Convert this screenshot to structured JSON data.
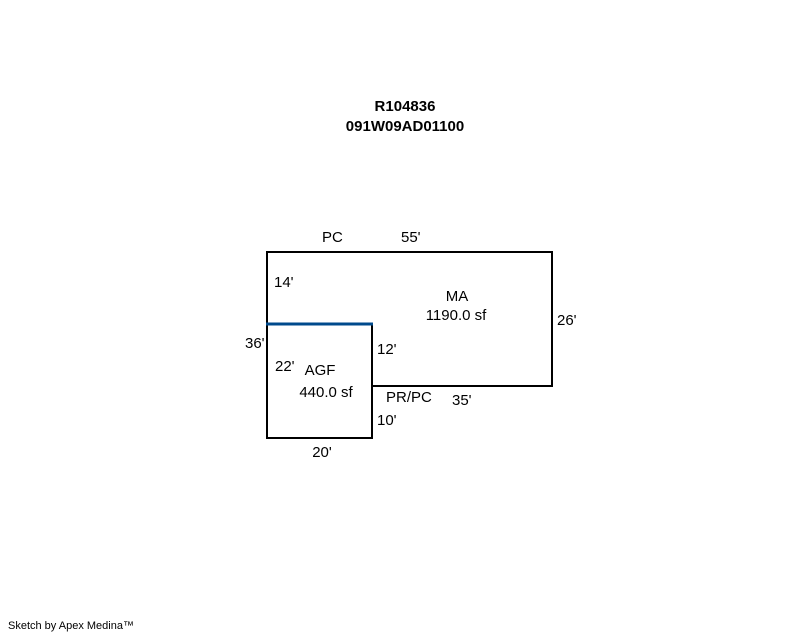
{
  "title": {
    "line1": "R104836",
    "line2": "091W09AD01100"
  },
  "sketch": {
    "areas": {
      "ma": {
        "name": "MA",
        "size": "1190.0 sf"
      },
      "agf": {
        "name": "AGF",
        "size": "440.0 sf"
      }
    },
    "dimensions": {
      "top_label": "PC",
      "top_length": "55'",
      "upper_left": "14'",
      "right": "26'",
      "left_total": "36'",
      "inner_upper": "12'",
      "agf_left": "22'",
      "bottom_right_label": "PR/PC",
      "bottom_right_length": "35'",
      "inner_lower": "10'",
      "agf_bottom": "20'"
    }
  },
  "footer": {
    "credit": "Sketch by Apex Medina™"
  },
  "colors": {
    "outline": "#000000",
    "agf_highlight": "#004a8c",
    "background": "#ffffff"
  }
}
